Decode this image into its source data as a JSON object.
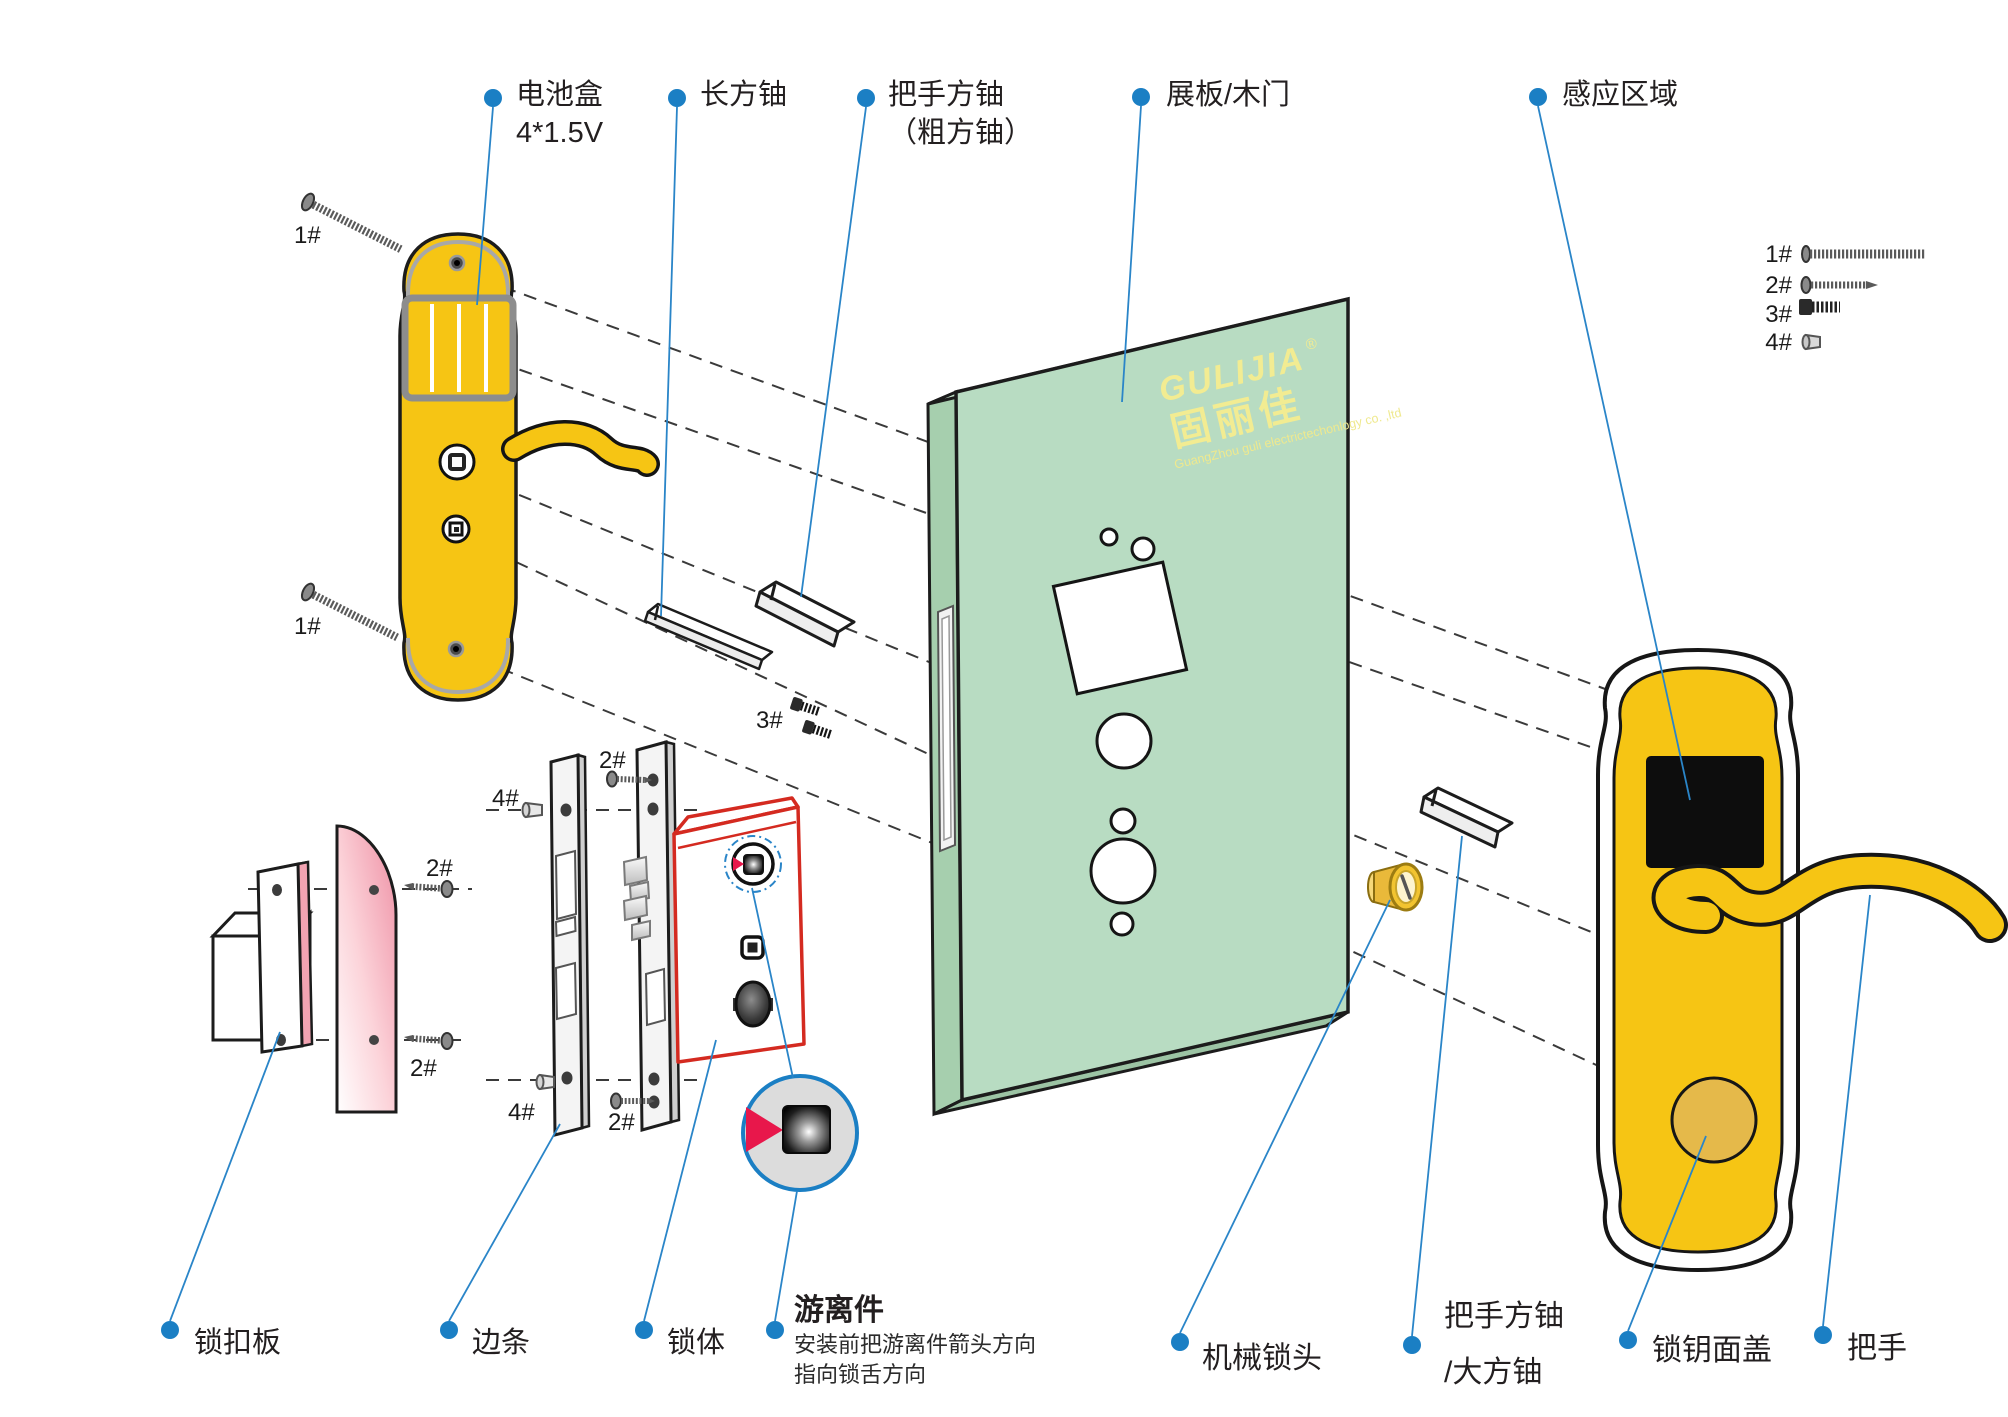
{
  "colors": {
    "accent_blue": "#1b7fc4",
    "leader_blue": "#2a85c8",
    "panel_yellow": "#f6c514",
    "door_green": "#b8dcc2",
    "lock_body_red": "#d42a20",
    "strike_pink": "#ee8fa4",
    "arrow_red": "#e8174b",
    "text": "#231f20"
  },
  "labels": {
    "battery_box": "电池盒",
    "battery_spec": "4*1.5V",
    "long_shaft": "长方铀",
    "handle_shaft": "把手方铀",
    "handle_shaft_sub": "（粗方铀）",
    "door": "展板/木门",
    "sensing_area": "感应区域",
    "strike_plate": "锁扣板",
    "edge_strip": "边条",
    "lock_body": "锁体",
    "floating_part": "游离件",
    "floating_note_1": "安装前把游离件箭头方向",
    "floating_note_2": "指向锁舌方向",
    "mech_cylinder": "机械锁头",
    "handle_shaft2": "把手方铀",
    "handle_shaft2_sub": "/大方铀",
    "key_cover": "锁钥面盖",
    "handle": "把手"
  },
  "screws": {
    "s1": "1#",
    "s2": "2#",
    "s3": "3#",
    "s4": "4#"
  },
  "legend": {
    "rows": [
      {
        "id": "1#"
      },
      {
        "id": "2#"
      },
      {
        "id": "3#"
      },
      {
        "id": "4#"
      }
    ]
  },
  "logo": {
    "brand_latin": "GULIJIA",
    "registered": "®",
    "brand_cn": "固丽佳",
    "company": "GuangZhou guli electrictechonlogy co. ,ltd"
  }
}
